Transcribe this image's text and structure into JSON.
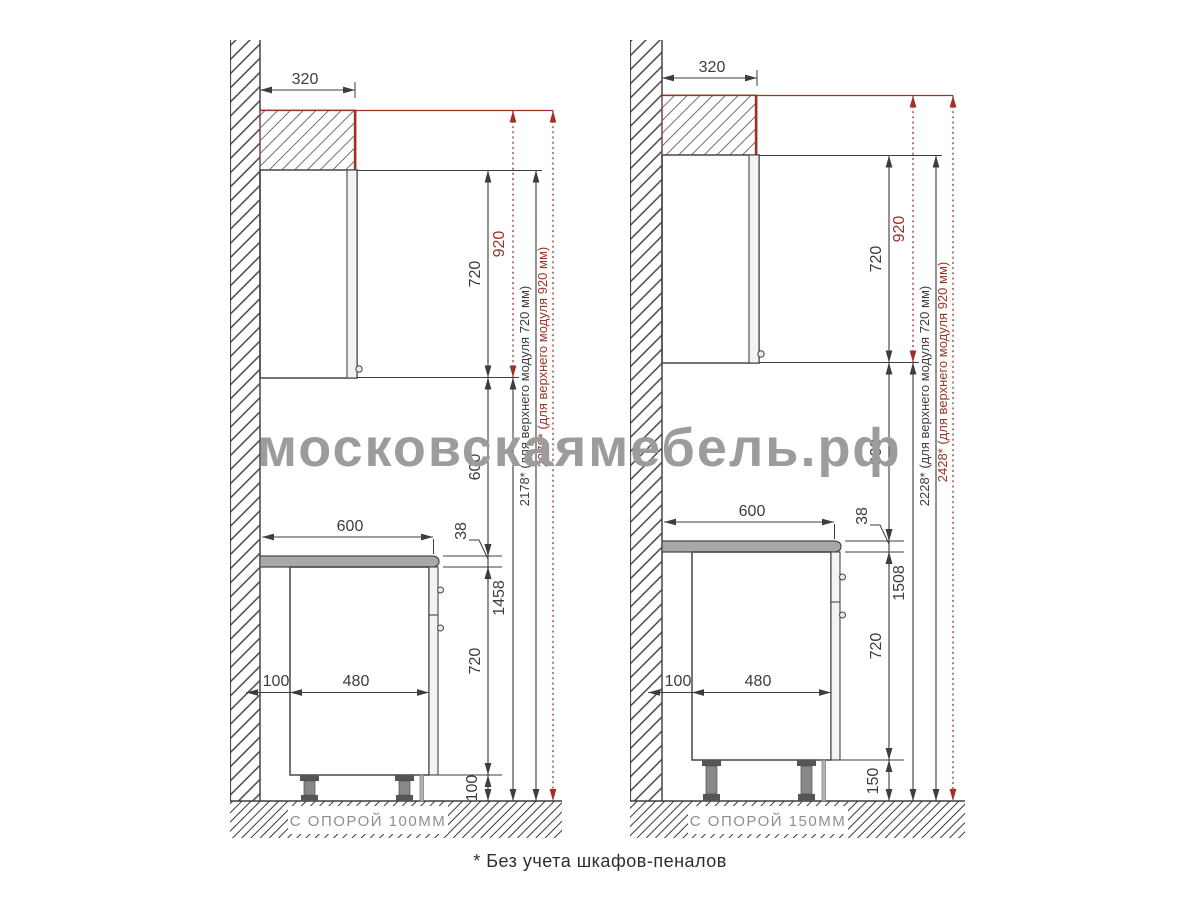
{
  "watermark": "московскаямебель.рф",
  "footnote": "* Без учета шкафов-пеналов",
  "colors": {
    "dimension_line": "#3d3d3d",
    "accent_red": "#9e3228",
    "cabinet_fill": "#c9c9c9",
    "counter_fill": "#a8a8a8",
    "watermark_gray": "#9c9c9c"
  },
  "panels": [
    {
      "caption": "С ОПОРОЙ 100ММ",
      "dims": {
        "top_depth": "320",
        "counter_depth": "600",
        "wall_gap": "100",
        "base_depth": "480",
        "upper_height": "720",
        "upper_zone_height": "920",
        "counter_to_upper": "600",
        "countertop_thickness": "38",
        "base_height": "720",
        "support_height": "100",
        "floor_to_upper": "1458",
        "total_note_720": "2178* (для верхнего модуля 720 мм)",
        "total_note_920": "2378* (для верхнего модуля 920 мм)"
      }
    },
    {
      "caption": "С ОПОРОЙ 150ММ",
      "dims": {
        "top_depth": "320",
        "counter_depth": "600",
        "wall_gap": "100",
        "base_depth": "480",
        "upper_height": "720",
        "upper_zone_height": "920",
        "counter_to_upper": "600",
        "countertop_thickness": "38",
        "base_height": "720",
        "support_height": "150",
        "floor_to_upper": "1508",
        "total_note_720": "2228* (для верхнего модуля 720 мм)",
        "total_note_920": "2428* (для верхнего модуля 920 мм)"
      }
    }
  ]
}
